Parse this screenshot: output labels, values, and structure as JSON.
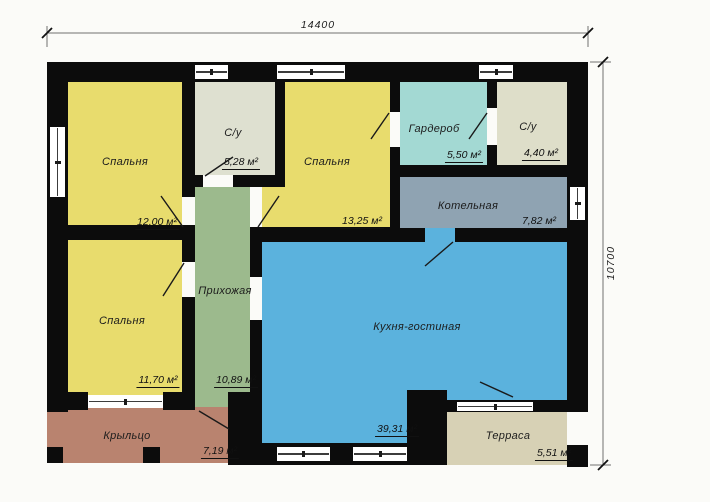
{
  "plan": {
    "title": "floor-plan",
    "width_dimension": "14400",
    "height_dimension": "10700",
    "rooms": [
      {
        "id": "bedroom-1",
        "name": "Спальня",
        "area": "12,00 м²"
      },
      {
        "id": "bathroom-1",
        "name": "С/у",
        "area": "5,28 м²"
      },
      {
        "id": "bedroom-2",
        "name": "Спальня",
        "area": "13,25 м²"
      },
      {
        "id": "wardrobe",
        "name": "Гардероб",
        "area": "5,50 м²"
      },
      {
        "id": "bathroom-2",
        "name": "С/у",
        "area": "4,40 м²"
      },
      {
        "id": "boiler-room",
        "name": "Котельная",
        "area": "7,82 м²"
      },
      {
        "id": "bedroom-3",
        "name": "Спальня",
        "area": "11,70 м²"
      },
      {
        "id": "hallway",
        "name": "Прихожая",
        "area": "10,89 м²"
      },
      {
        "id": "kitchen-living-room",
        "name": "Кухня-гостиная",
        "area": "39,31 м²"
      },
      {
        "id": "porch",
        "name": "Крыльцо",
        "area": "7,19 м²"
      },
      {
        "id": "terrace",
        "name": "Терраса",
        "area": "5,51 м²"
      }
    ],
    "colors": {
      "bedroom": "#e8dc6d",
      "bathroom1": "#dee0d0",
      "bathroom2": "#dedec9",
      "wardrobe": "#a3d9d3",
      "boiler": "#8fa3b2",
      "hallway": "#9cba8d",
      "kitchen": "#5bb2dd",
      "porch": "#b9836f",
      "terrace": "#d7d1b5",
      "wall": "#0c0c0c"
    }
  }
}
